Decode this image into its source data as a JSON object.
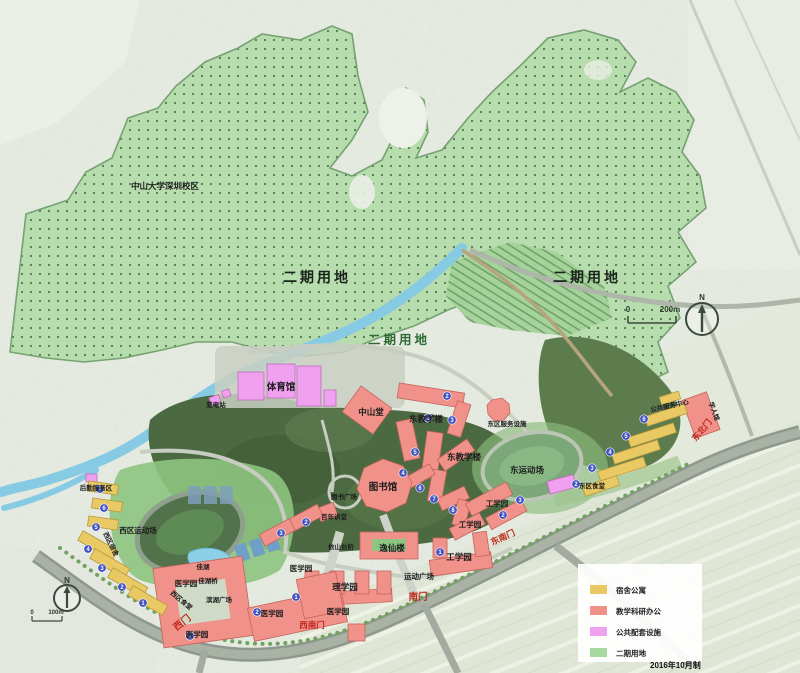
{
  "labels": {
    "campus_area": "中山大学深圳校区",
    "phase2_left": "二期用地",
    "phase2_right": "二期用地",
    "phase2_mid": "二期用地",
    "gymnasium": "体育馆",
    "zhongshan_hall": "中山堂",
    "substation": "变电站",
    "east_teaching_1": "东教学楼",
    "east_teaching_2": "东教学楼",
    "east_service": "东区服务设施",
    "east_field": "东运动场",
    "library": "图书馆",
    "library_plaza": "图书广场",
    "centennial_hall": "百年讲堂",
    "hill_steps": "依山台阶",
    "yixian_building": "逸仙楼",
    "sports_plaza": "运动广场",
    "science_park": "理学园",
    "eng_park_1": "工学园",
    "eng_park_2": "工学园",
    "eng_park_3": "工学园",
    "med_park_1": "医学园",
    "med_park_2": "医学园",
    "med_park_3": "医学园",
    "med_park_4": "医学园",
    "med_park_5": "医学园",
    "jia_lake": "佳湖",
    "jia_lake_bridge": "佳湖桥",
    "lakeside_plaza": "滨湖广场",
    "west_canteen": "西区食堂",
    "east_canteen": "东区食堂",
    "west_field": "西区运动场",
    "west_dorm": "西区宿舍",
    "logistics_area": "后勤服务区",
    "guest_house": "学人馆",
    "service_center": "公共服务中心",
    "gate_south": "南门",
    "gate_southeast": "东南门",
    "gate_southwest": "西南门",
    "gate_west": "西门",
    "gate_northeast": "东北门"
  },
  "compass": {
    "north_top": "N",
    "north_bottom": "N"
  },
  "scalebar_top": {
    "zero": "0",
    "length": "200m"
  },
  "scalebar_bottom": {
    "zero": "0",
    "length": "100m"
  },
  "legend": {
    "items": [
      {
        "label": "宿舍公寓",
        "color": "#e8c963"
      },
      {
        "label": "教学科研办公",
        "color": "#f0928a"
      },
      {
        "label": "公共配套设施",
        "color": "#efa0ee"
      },
      {
        "label": "二期用地",
        "color": "#a5d9a0"
      }
    ]
  },
  "note_date": "2016年10月制",
  "colors": {
    "phase2_fill": "#b7dcae",
    "forest": "#4c6a41",
    "river": "#87cae4",
    "road": "#97a096",
    "gate_text": "#c0271c",
    "marker_blue": "#3f51c0"
  },
  "markers": [
    "2",
    "1",
    "3",
    "5",
    "4",
    "6",
    "7",
    "8",
    "2",
    "3",
    "1",
    "2",
    "3",
    "1",
    "1",
    "2",
    "7",
    "6",
    "5",
    "4",
    "3",
    "2",
    "1",
    "4",
    "5",
    "6",
    "3",
    "2"
  ]
}
